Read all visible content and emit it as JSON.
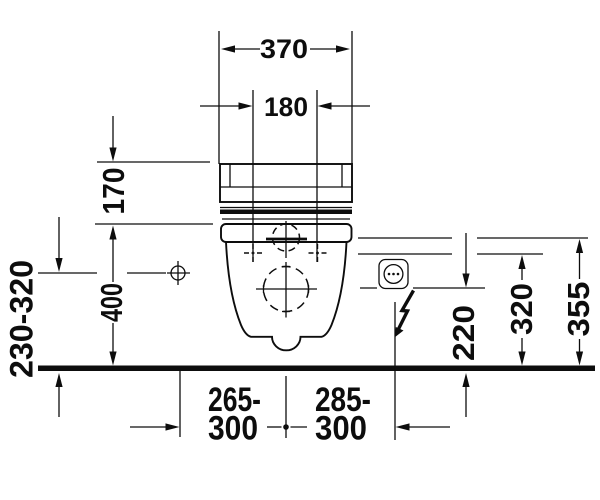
{
  "diagram": {
    "labels": {
      "width_overall": "370",
      "fixing_holes_spacing": "180",
      "cistern_section_height": "170",
      "rim_height": "400",
      "water_supply_height_range": "230-320",
      "left_offset_top": "265-",
      "left_offset_bottom": "300",
      "right_offset_top": "285-",
      "right_offset_bottom": "300",
      "outlet_zone_height": "220",
      "socket_zone_mid_height": "320",
      "socket_zone_top_height": "355"
    }
  }
}
